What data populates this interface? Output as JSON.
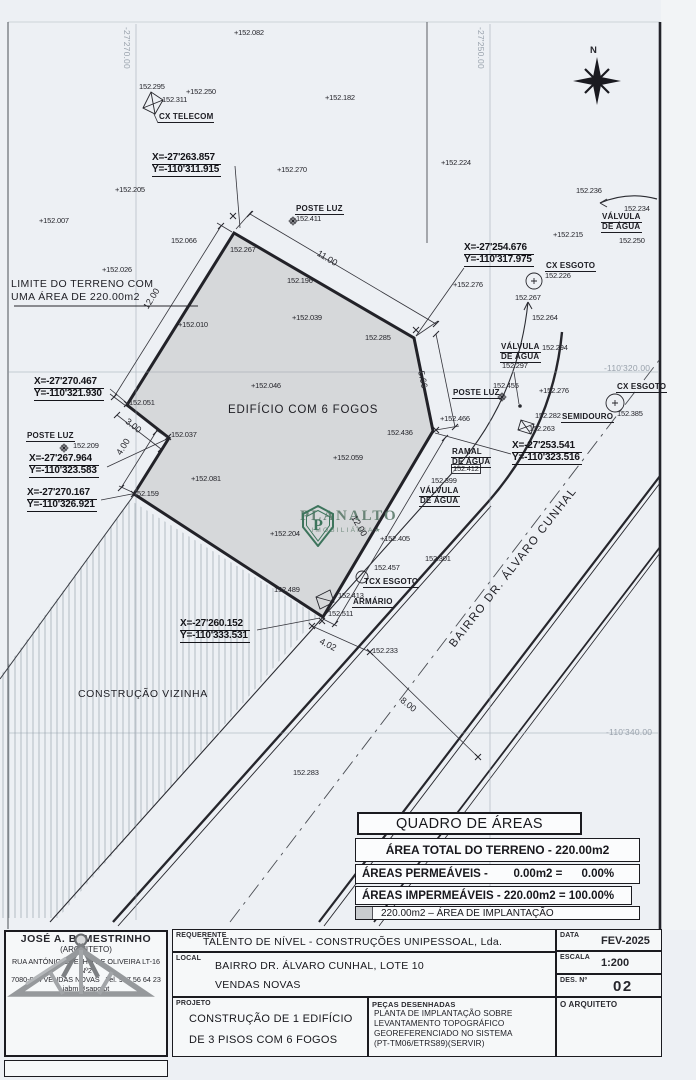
{
  "plan": {
    "north_label": "N",
    "grid_labels": [
      {
        "t": "-27'270.00",
        "x": 131,
        "y": 27,
        "rot": 90
      },
      {
        "t": "-27'250.00",
        "x": 485,
        "y": 27,
        "rot": 90
      },
      {
        "t": "-110'320.00",
        "x": 604,
        "y": 364,
        "rot": 0
      },
      {
        "t": "-110'340.00",
        "x": 606,
        "y": 728,
        "rot": 0
      }
    ],
    "texts": {
      "limit_line1": "LIMITE DO TERRENO COM",
      "limit_line2": "UMA ÁREA DE 220.00m2",
      "building": "EDIFÍCIO COM 6 FOGOS",
      "neighbor": "CONSTRUÇÃO VIZINHA",
      "street": "BAIRRO DR. ÁLVARO CUNHAL"
    },
    "coordinate_callouts": [
      {
        "x_label": "X=-27'263.857",
        "y_label": "Y=-110'311.915",
        "x": 152,
        "y": 153
      },
      {
        "x_label": "X=-27'254.676",
        "y_label": "Y=-110'317.975",
        "x": 464,
        "y": 243
      },
      {
        "x_label": "X=-27'270.467",
        "y_label": "Y=-110'321.930",
        "x": 34,
        "y": 377
      },
      {
        "x_label": "X=-27'267.964",
        "y_label": "Y=-110'323.583",
        "x": 29,
        "y": 454
      },
      {
        "x_label": "X=-27'270.167",
        "y_label": "Y=-110'326.921",
        "x": 27,
        "y": 488
      },
      {
        "x_label": "X=-27'253.541",
        "y_label": "Y=-110'323.516",
        "x": 512,
        "y": 441
      },
      {
        "x_label": "X=-27'260.152",
        "y_label": "Y=-110'333.531",
        "x": 180,
        "y": 619
      }
    ],
    "utility_labels": [
      {
        "lines": [
          "CX TELECOM"
        ],
        "x": 158,
        "y": 113
      },
      {
        "lines": [
          "POSTE LUZ"
        ],
        "x": 295,
        "y": 205
      },
      {
        "lines": [
          "CX ESGOTO"
        ],
        "x": 545,
        "y": 262
      },
      {
        "lines": [
          "VÁLVULA",
          "DE ÁGUA"
        ],
        "x": 601,
        "y": 213
      },
      {
        "lines": [
          "VÁLVULA",
          "DE ÁGUA"
        ],
        "x": 500,
        "y": 343
      },
      {
        "lines": [
          "POSTE LUZ"
        ],
        "x": 452,
        "y": 389
      },
      {
        "lines": [
          "CX ESGOTO"
        ],
        "x": 616,
        "y": 383
      },
      {
        "lines": [
          "SEMIDOURO"
        ],
        "x": 561,
        "y": 413
      },
      {
        "lines": [
          "RAMAL",
          "DE ÁGUA"
        ],
        "x": 451,
        "y": 448
      },
      {
        "lines": [
          "VÁLVULA",
          "DE ÁGUA"
        ],
        "x": 419,
        "y": 487
      },
      {
        "lines": [
          "POSTE LUZ"
        ],
        "x": 26,
        "y": 432
      },
      {
        "lines": [
          "TCX ESGOTO"
        ],
        "x": 363,
        "y": 578
      },
      {
        "lines": [
          "ARMÁRIO"
        ],
        "x": 352,
        "y": 598
      }
    ],
    "spot_elevations": [
      {
        "t": "+152.082",
        "x": 234,
        "y": 29
      },
      {
        "t": "152.295",
        "x": 139,
        "y": 83
      },
      {
        "t": "+152.250",
        "x": 186,
        "y": 88
      },
      {
        "t": "152.311",
        "x": 162,
        "y": 96
      },
      {
        "t": "+152.182",
        "x": 325,
        "y": 94
      },
      {
        "t": "+152.270",
        "x": 277,
        "y": 166
      },
      {
        "t": "+152.205",
        "x": 115,
        "y": 186
      },
      {
        "t": "+152.007",
        "x": 39,
        "y": 217
      },
      {
        "t": "152.066",
        "x": 171,
        "y": 237
      },
      {
        "t": "+152.026",
        "x": 102,
        "y": 266
      },
      {
        "t": "152.267",
        "x": 230,
        "y": 246
      },
      {
        "t": "152.196",
        "x": 287,
        "y": 277
      },
      {
        "t": "+152.039",
        "x": 292,
        "y": 314
      },
      {
        "t": "152.285",
        "x": 365,
        "y": 334
      },
      {
        "t": "+152.224",
        "x": 441,
        "y": 159
      },
      {
        "t": "152.236",
        "x": 576,
        "y": 187
      },
      {
        "t": "152.234",
        "x": 624,
        "y": 205
      },
      {
        "t": "+152.215",
        "x": 553,
        "y": 231
      },
      {
        "t": "152.250",
        "x": 619,
        "y": 237
      },
      {
        "t": "152.226",
        "x": 545,
        "y": 272
      },
      {
        "t": "+152.276",
        "x": 453,
        "y": 281
      },
      {
        "t": "152.267",
        "x": 515,
        "y": 294
      },
      {
        "t": "152.264",
        "x": 532,
        "y": 314
      },
      {
        "t": "152.294",
        "x": 542,
        "y": 344
      },
      {
        "t": "152.297",
        "x": 502,
        "y": 362
      },
      {
        "t": "152.455",
        "x": 493,
        "y": 382
      },
      {
        "t": "+152.276",
        "x": 539,
        "y": 387
      },
      {
        "t": "+152.466",
        "x": 440,
        "y": 415
      },
      {
        "t": "152.282",
        "x": 535,
        "y": 412
      },
      {
        "t": "152.263",
        "x": 529,
        "y": 425
      },
      {
        "t": "152.385",
        "x": 617,
        "y": 410
      },
      {
        "t": "+152.010",
        "x": 178,
        "y": 321
      },
      {
        "t": "+152.046",
        "x": 251,
        "y": 382
      },
      {
        "t": "152.436",
        "x": 387,
        "y": 429
      },
      {
        "t": "+152.059",
        "x": 333,
        "y": 454
      },
      {
        "t": "152.051",
        "x": 129,
        "y": 399
      },
      {
        "t": "152.209",
        "x": 73,
        "y": 442
      },
      {
        "t": "152.037",
        "x": 171,
        "y": 431
      },
      {
        "t": "+152.081",
        "x": 191,
        "y": 475
      },
      {
        "t": "152.159",
        "x": 133,
        "y": 490
      },
      {
        "t": "+152.204",
        "x": 270,
        "y": 530
      },
      {
        "t": "+152.405",
        "x": 380,
        "y": 535
      },
      {
        "t": "152.301",
        "x": 425,
        "y": 555
      },
      {
        "t": "152.489",
        "x": 274,
        "y": 586
      },
      {
        "t": "152.457",
        "x": 374,
        "y": 564
      },
      {
        "t": "152.413",
        "x": 338,
        "y": 592
      },
      {
        "t": "152.511",
        "x": 328,
        "y": 610
      },
      {
        "t": "152.412",
        "x": 451,
        "y": 464,
        "boxed": true
      },
      {
        "t": "152.399",
        "x": 431,
        "y": 477
      },
      {
        "t": "152.233",
        "x": 372,
        "y": 647
      },
      {
        "t": "152.283",
        "x": 293,
        "y": 769
      },
      {
        "t": "152.411",
        "x": 296,
        "y": 215
      }
    ],
    "dimension_labels": [
      {
        "t": "11.00",
        "x": 320,
        "y": 249,
        "rot": 31
      },
      {
        "t": "5.66",
        "x": 425,
        "y": 370,
        "rot": 78
      },
      {
        "t": "12.00",
        "x": 142,
        "y": 306,
        "rot": -58
      },
      {
        "t": "12.00",
        "x": 357,
        "y": 514,
        "rot": 60
      },
      {
        "t": "3.00",
        "x": 129,
        "y": 417,
        "rot": 38
      },
      {
        "t": "4.00",
        "x": 115,
        "y": 452,
        "rot": -58
      },
      {
        "t": "4.02",
        "x": 322,
        "y": 637,
        "rot": 27
      },
      {
        "t": "8.00",
        "x": 404,
        "y": 696,
        "rot": 38
      }
    ]
  },
  "watermark": {
    "brand": "PLANALTO",
    "sub": "IMOBILIÁRIA★",
    "initial": "P"
  },
  "areas_table": {
    "title": "QUADRO DE ÁREAS",
    "total_row": "ÁREA TOTAL DO TERRENO - 220.00m2",
    "permeable_row": "ÁREAS PERMEÁVEIS -        0.00m2 =      0.00%",
    "impermeable_row": "ÁREAS IMPERMEÁVEIS - 220.00m2 = 100.00%",
    "implantation_row": "220.00m2 – ÁREA DE IMPLANTAÇÃO"
  },
  "title_block": {
    "requerente_label": "REQUERENTE",
    "requerente_value": "TALENTO DE NÍVEL - CONSTRUÇÕES UNIPESSOAL, Lda.",
    "local_label": "LOCAL",
    "local_line1": "BAIRRO DR. ÁLVARO CUNHAL, LOTE 10",
    "local_line2": "VENDAS NOVAS",
    "projeto_label": "PROJETO",
    "projeto_line1": "CONSTRUÇÃO DE 1 EDIFÍCIO",
    "projeto_line2": "DE 3 PISOS COM 6 FOGOS",
    "pecas_label": "PEÇAS DESENHADAS",
    "pecas_line1": "PLANTA DE IMPLANTAÇÃO SOBRE",
    "pecas_line2": "LEVANTAMENTO TOPOGRÁFICO",
    "pecas_line3": "GEOREFERENCIADO NO SISTEMA",
    "pecas_line4": "(PT-TM06/ETRS89)(SERVIR)",
    "data_label": "DATA",
    "data_value": "FEV-2025",
    "escala_label": "ESCALA",
    "escala_value": "1:200",
    "des_label": "DES. Nº",
    "des_value": "02",
    "arquiteto_label": "O ARQUITETO",
    "architect": {
      "name": "JOSÉ A. B. MESTRINHO",
      "role": "(ARQUITETO)",
      "address1": "RUA ANTÓNIO COELHO DE OLIVEIRA LT-16 Nº2",
      "address2": "7080-084 VENDAS NOVAS",
      "phone": "Tel. 937 56 64 23",
      "email": "jabm@sapo.pt"
    }
  }
}
